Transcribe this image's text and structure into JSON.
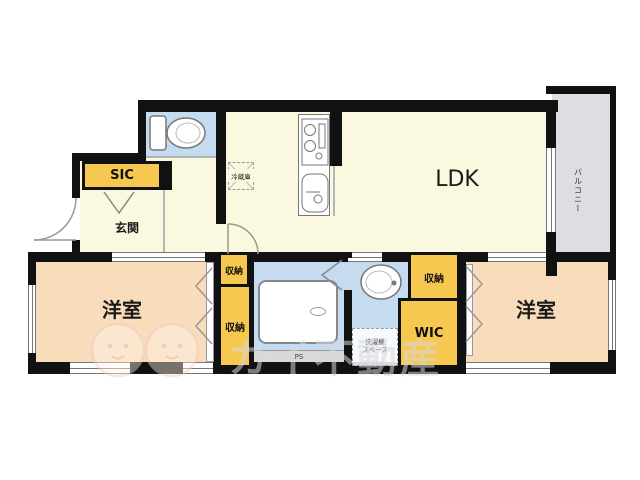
{
  "rooms": {
    "ldk": {
      "label": "LDK"
    },
    "bedroom_left": {
      "label": "洋室"
    },
    "bedroom_right": {
      "label": "洋室"
    },
    "entrance": {
      "label": "玄関"
    },
    "sic": {
      "label": "SIC"
    },
    "wic": {
      "label": "WIC"
    },
    "closet_mid_top": {
      "label": "収納"
    },
    "closet_mid_tall": {
      "label": "収納"
    },
    "closet_right": {
      "label": "収納"
    },
    "balcony": {
      "label": "バルコニー"
    },
    "refrigerator": {
      "label": "冷蔵庫"
    },
    "laundry": {
      "line1": "洗濯機",
      "line2": "スペース"
    },
    "ps": {
      "label": "PS"
    }
  },
  "watermark": {
    "text": "カイ不動産"
  },
  "fixtures": [
    "toilet-icon",
    "stove-icon",
    "sink-icon",
    "bathtub",
    "washbasin-icon",
    "refrigerator-outline",
    "washing-machine-space"
  ],
  "colors": {
    "wall_black": "#111111",
    "floor_cream": "#FAF8DE",
    "floor_blue": "#C5DCF0",
    "floor_peach": "#F8DCBC",
    "closet_yellow": "#F6C84F",
    "balcony_gray": "#DEDDE4",
    "ps_gray": "#D9D9D9"
  }
}
